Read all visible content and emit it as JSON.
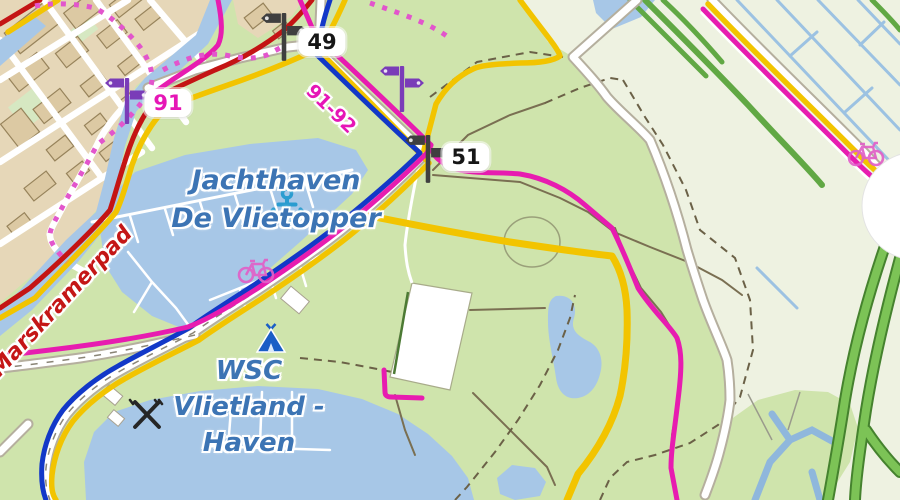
{
  "map": {
    "labels": {
      "marina_name_line1": "Jachthaven",
      "marina_name_line2": "De Vlietopper",
      "harbor_name_line1": "WSC",
      "harbor_name_line2": "Vlietland -",
      "harbor_name_line3": "Haven",
      "trail_name": "Marskramerpad",
      "route_segment": "91-92"
    },
    "junctions": {
      "node_49": "49",
      "node_51": "51",
      "node_91": "91"
    },
    "icons": [
      "guidepost-icon",
      "anchor-icon",
      "bicycle-icon",
      "tent-icon",
      "picnic-icon",
      "white-circle-control"
    ],
    "colors": {
      "cycle_route": "#e71cb0",
      "walking_route": "#c41414",
      "blue_route": "#1238c8",
      "road_yellow": "#f2c400",
      "dashed_route_pink": "#e255cc",
      "water": "#a7c7e7",
      "park_green": "#cfe4ac",
      "field_pale": "#eef2e1",
      "urban_tan": "#e6d7b8",
      "guidepost_purple": "#7a3cb8",
      "guidepost_dark": "#3f3f3f",
      "label_blue": "#3c74b4",
      "label_red": "#c41616",
      "motorway_green": "#7cc356"
    }
  }
}
